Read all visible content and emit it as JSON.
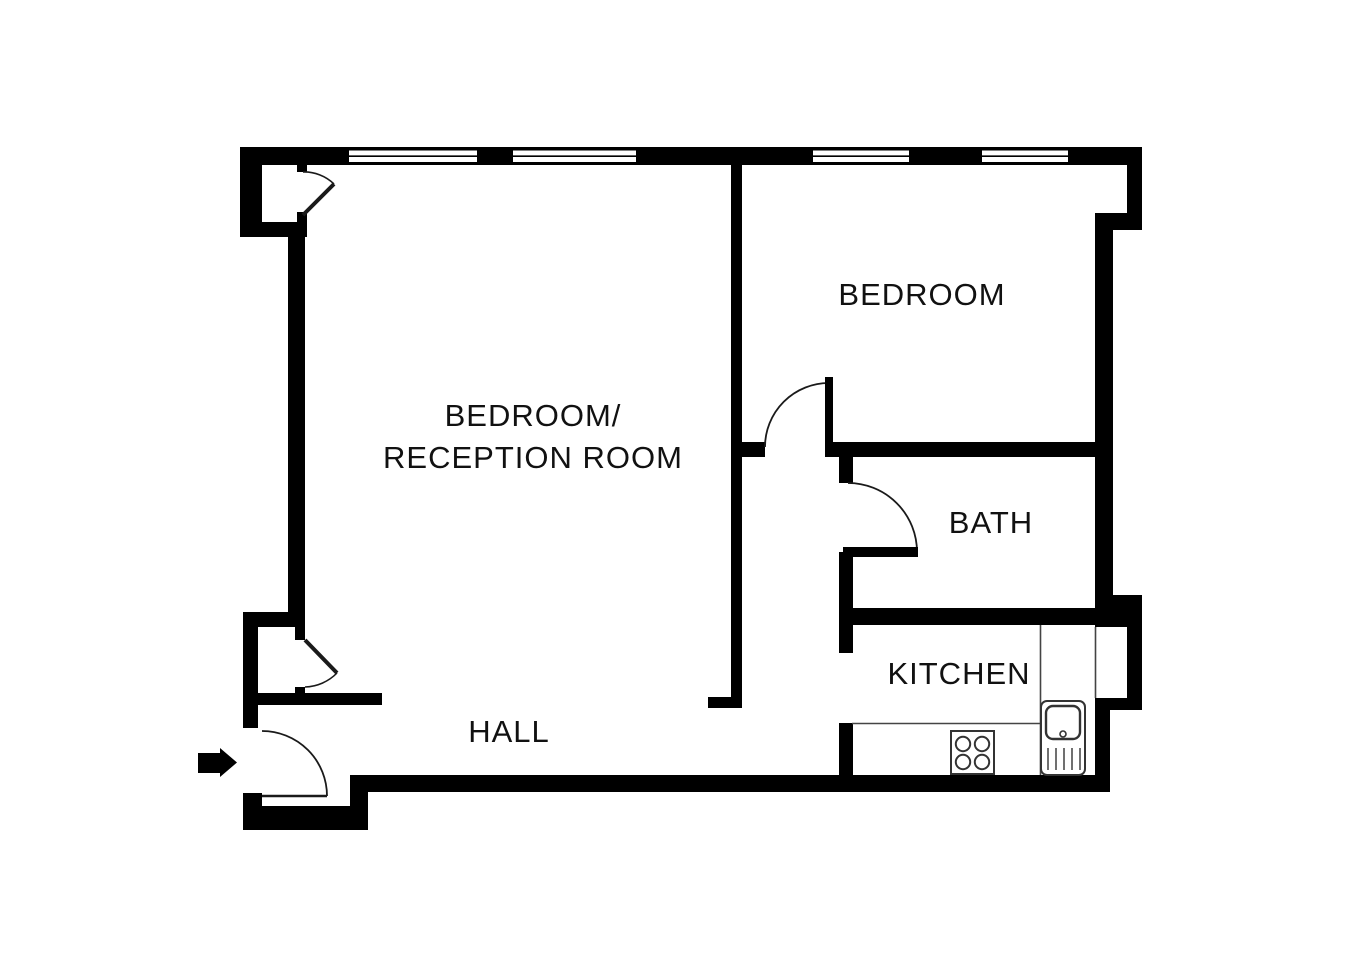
{
  "rooms": {
    "reception": {
      "line1": "BEDROOM/",
      "line2": "RECEPTION ROOM"
    },
    "bedroom": {
      "label": "BEDROOM"
    },
    "bath": {
      "label": "BATH"
    },
    "kitchen": {
      "label": "KITCHEN"
    },
    "hall": {
      "label": "HALL"
    }
  },
  "fixtures": {
    "stove": "stove-hob-icon",
    "sink": "sink-drainer-icon"
  },
  "entrance": {
    "indicator": "entrance-arrow-right"
  },
  "colors": {
    "wall": "#000000",
    "background": "#ffffff",
    "text": "#111111",
    "fixture_outline": "#333333"
  }
}
